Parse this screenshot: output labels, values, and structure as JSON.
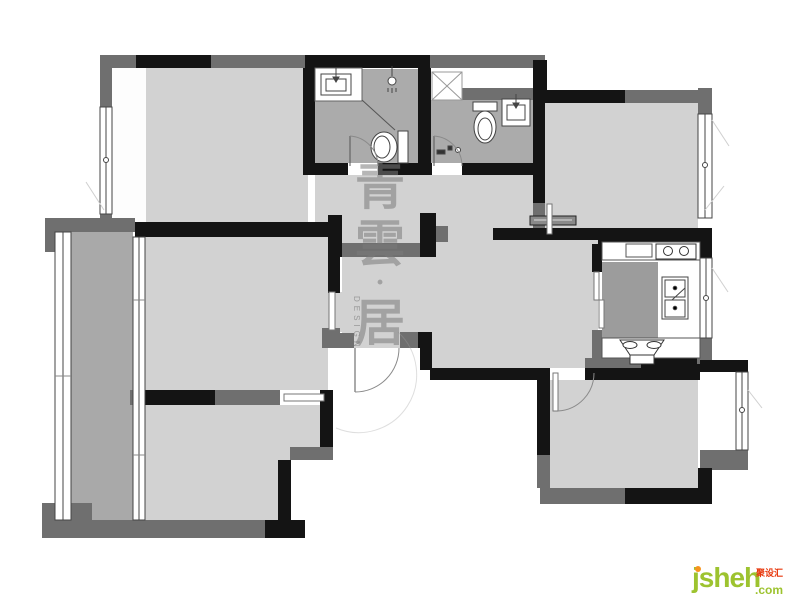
{
  "watermark": {
    "chars": [
      "青",
      "雲",
      "·",
      "居"
    ],
    "joined": "青雲·居",
    "design_label": "DESIGN",
    "color": "#7a7a7a"
  },
  "logo": {
    "brand": "jsheh",
    "tld": ".com",
    "badge": "聚设汇",
    "brand_color": "#9dc32f",
    "badge_color": "#e8380d",
    "dot_color": "#f7941e"
  },
  "palette": {
    "wall_black": "#141414",
    "wall_gray": "#6f6f6f",
    "floor": "#d2d2d2",
    "balcony_floor": "#a9a9a9",
    "bathroom_floor": "#ababab",
    "kitchen_block": "#9c9c9c",
    "background": "#ffffff"
  },
  "fixtures": [
    "bathroom-sink",
    "shower-head",
    "toilet",
    "shower-tray",
    "toilet",
    "bathroom-sink",
    "cooktop-burners",
    "kitchen-sink",
    "range-hood-stove",
    "wardrobe",
    "entry-door",
    "window"
  ]
}
